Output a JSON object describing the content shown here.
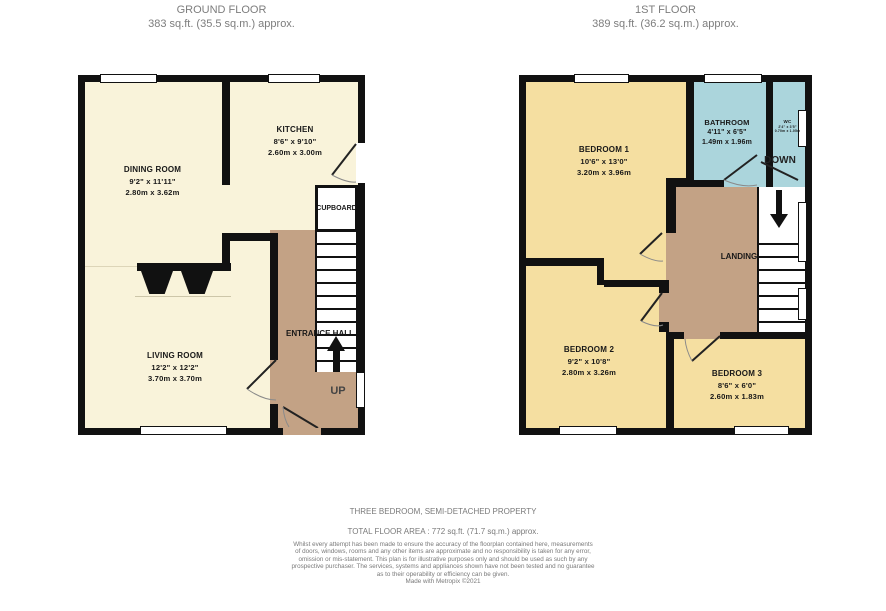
{
  "headers": {
    "ground": {
      "title": "GROUND FLOOR",
      "area": "383 sq.ft. (35.5 sq.m.) approx."
    },
    "first": {
      "title": "1ST FLOOR",
      "area": "389 sq.ft. (36.2 sq.m.) approx."
    }
  },
  "ground_floor": {
    "dining_room": {
      "name": "DINING ROOM",
      "imperial": "9'2\" x 11'11\"",
      "metric": "2.80m x 3.62m"
    },
    "kitchen": {
      "name": "KITCHEN",
      "imperial": "8'6\" x 9'10\"",
      "metric": "2.60m x 3.00m"
    },
    "living_room": {
      "name": "LIVING ROOM",
      "imperial": "12'2\" x 12'2\"",
      "metric": "3.70m x 3.70m"
    },
    "cupboard": {
      "name": "CUPBOARD"
    },
    "entrance_hall": {
      "name": "ENTRANCE HALL"
    },
    "up": "UP"
  },
  "first_floor": {
    "bedroom1": {
      "name": "BEDROOM 1",
      "imperial": "10'6\" x 13'0\"",
      "metric": "3.20m x 3.96m"
    },
    "bathroom": {
      "name": "BATHROOM",
      "imperial": "4'11\" x 6'5\"",
      "metric": "1.49m x 1.96m"
    },
    "wc": {
      "name": "WC",
      "imperial": "2'4\" x 3'5\"",
      "metric": "0.70m x 1.05m"
    },
    "bedroom2": {
      "name": "BEDROOM 2",
      "imperial": "9'2\" x 10'8\"",
      "metric": "2.80m x 3.26m"
    },
    "bedroom3": {
      "name": "BEDROOM 3",
      "imperial": "8'6\" x 6'0\"",
      "metric": "2.60m x 1.83m"
    },
    "landing": {
      "name": "LANDING"
    },
    "down": "DOWN"
  },
  "footer": {
    "property_type": "THREE BEDROOM, SEMI-DETACHED PROPERTY",
    "total_area": "TOTAL FLOOR AREA : 772 sq.ft. (71.7 sq.m.) approx.",
    "disclaimer_lines": [
      "Whilst every attempt has been made to ensure the accuracy of the floorplan contained here, measurements",
      "of doors, windows, rooms and any other items are approximate and no responsibility is taken for any error,",
      "omission or mis-statement. This plan is for illustrative purposes only and should be used as such by any",
      "prospective purchaser. The services, systems and appliances shown have not been tested and no guarantee",
      "as to their operability or efficiency can be given."
    ],
    "credit": "Made with Metropix ©2021"
  },
  "colors": {
    "wall": "#111111",
    "ground_room": "#f9f3da",
    "bedroom": "#f5dfa1",
    "bathroom": "#abd5dc",
    "hall_tan": "#c3a285",
    "header_text": "#7d7d7d",
    "footer_text": "#7a7a7a"
  }
}
